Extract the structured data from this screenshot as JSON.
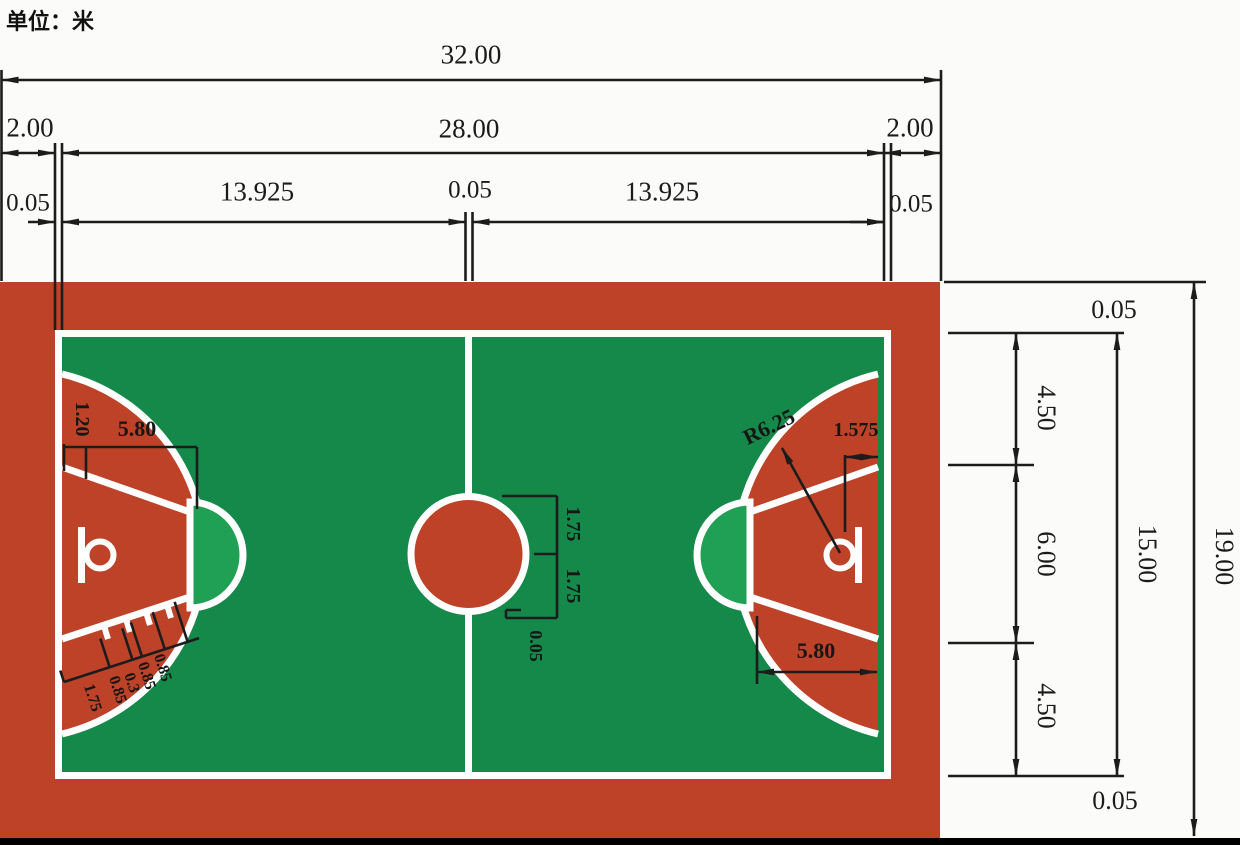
{
  "unit": {
    "label": "单位：米"
  },
  "colors": {
    "apron_red": "#BE4227",
    "court_green": "#15894A",
    "semi_green": "#1FA054",
    "line_white": "#ffffff",
    "dim_black": "#1c1c1c"
  },
  "dims": {
    "overall_w": "32.00",
    "buffer_l": "2.00",
    "court_len": "28.00",
    "buffer_r": "2.00",
    "line_l": "0.05",
    "half_l": "13.925",
    "line_c": "0.05",
    "half_r": "13.925",
    "line_r": "0.05",
    "right_line_top": "0.05",
    "right_450_top": "4.50",
    "right_600": "6.00",
    "right_450_bot": "4.50",
    "court_w": "15.00",
    "overall_h": "19.00",
    "right_line_bot": "0.05",
    "backboard_off": "1.20",
    "ft_dist_l": "5.80",
    "cc_r_top": "1.75",
    "cc_r_bot": "1.75",
    "cc_line": "0.05",
    "three_pt": "R6.25",
    "basket_off": "1.575",
    "ft_dist_r": "5.80",
    "lane_marks": [
      "1.75",
      "0.85",
      "0.3",
      "0.85",
      "0.85"
    ]
  }
}
